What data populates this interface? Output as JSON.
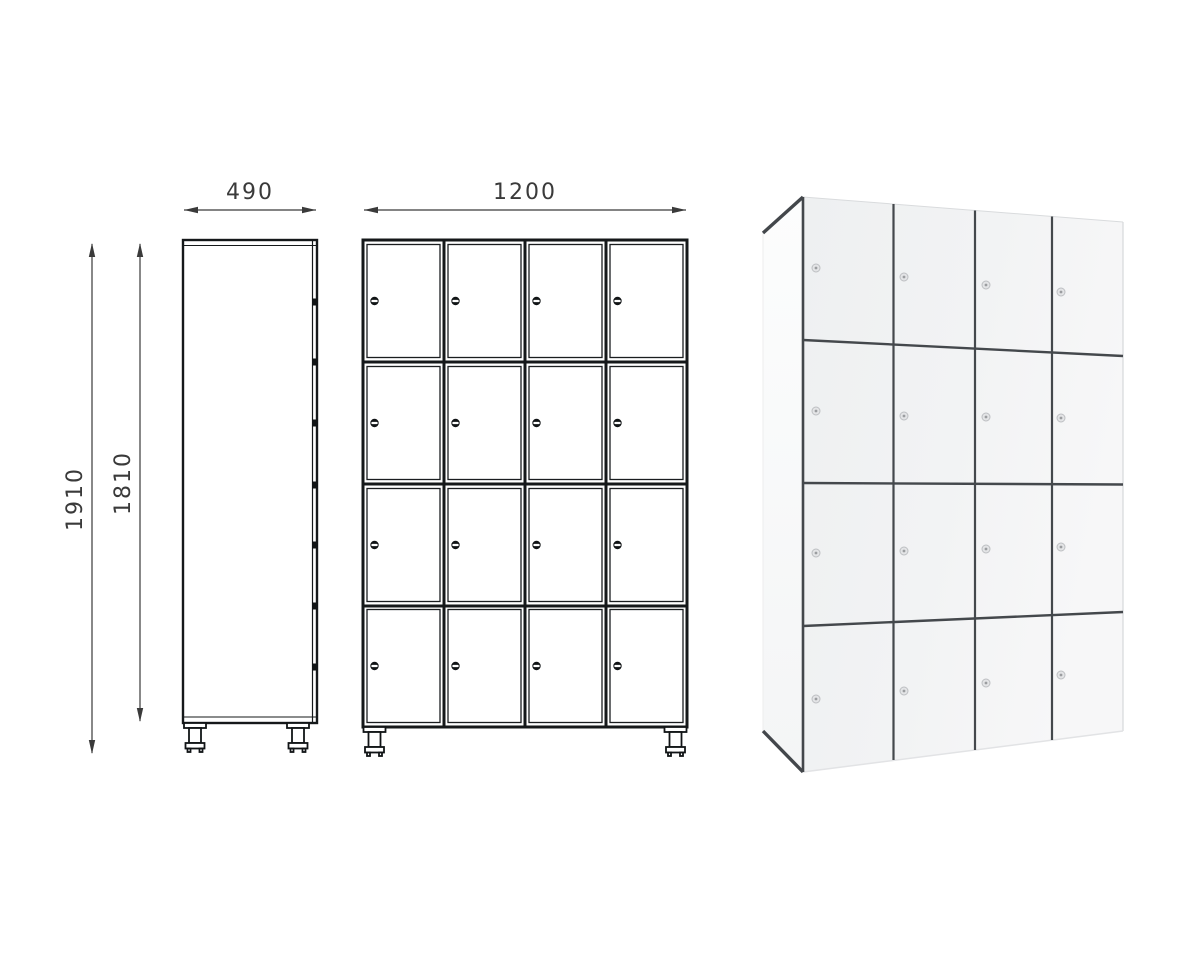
{
  "page": {
    "background": "#ffffff",
    "description_text": ""
  },
  "drawing": {
    "line_color": "#15181a",
    "dim_color": "#3a3a3a",
    "dim_depth": {
      "value": "490"
    },
    "dim_width": {
      "value": "1200"
    },
    "dim_height_total": {
      "value": "1910"
    },
    "dim_height_body": {
      "value": "1810"
    },
    "front_view": {
      "rows": 4,
      "columns": 4,
      "compartments": 16,
      "lock_style": "cam-lock-dot"
    },
    "side_view": {
      "latch_marks": 7,
      "feet": 2
    }
  },
  "render_3d": {
    "rows": 4,
    "columns": 4,
    "compartments": 16,
    "front_color": "#f1f2f3",
    "side_color": "#fafbfc",
    "seam_color": "#43474b",
    "lock_color": "#e3e4e6"
  }
}
